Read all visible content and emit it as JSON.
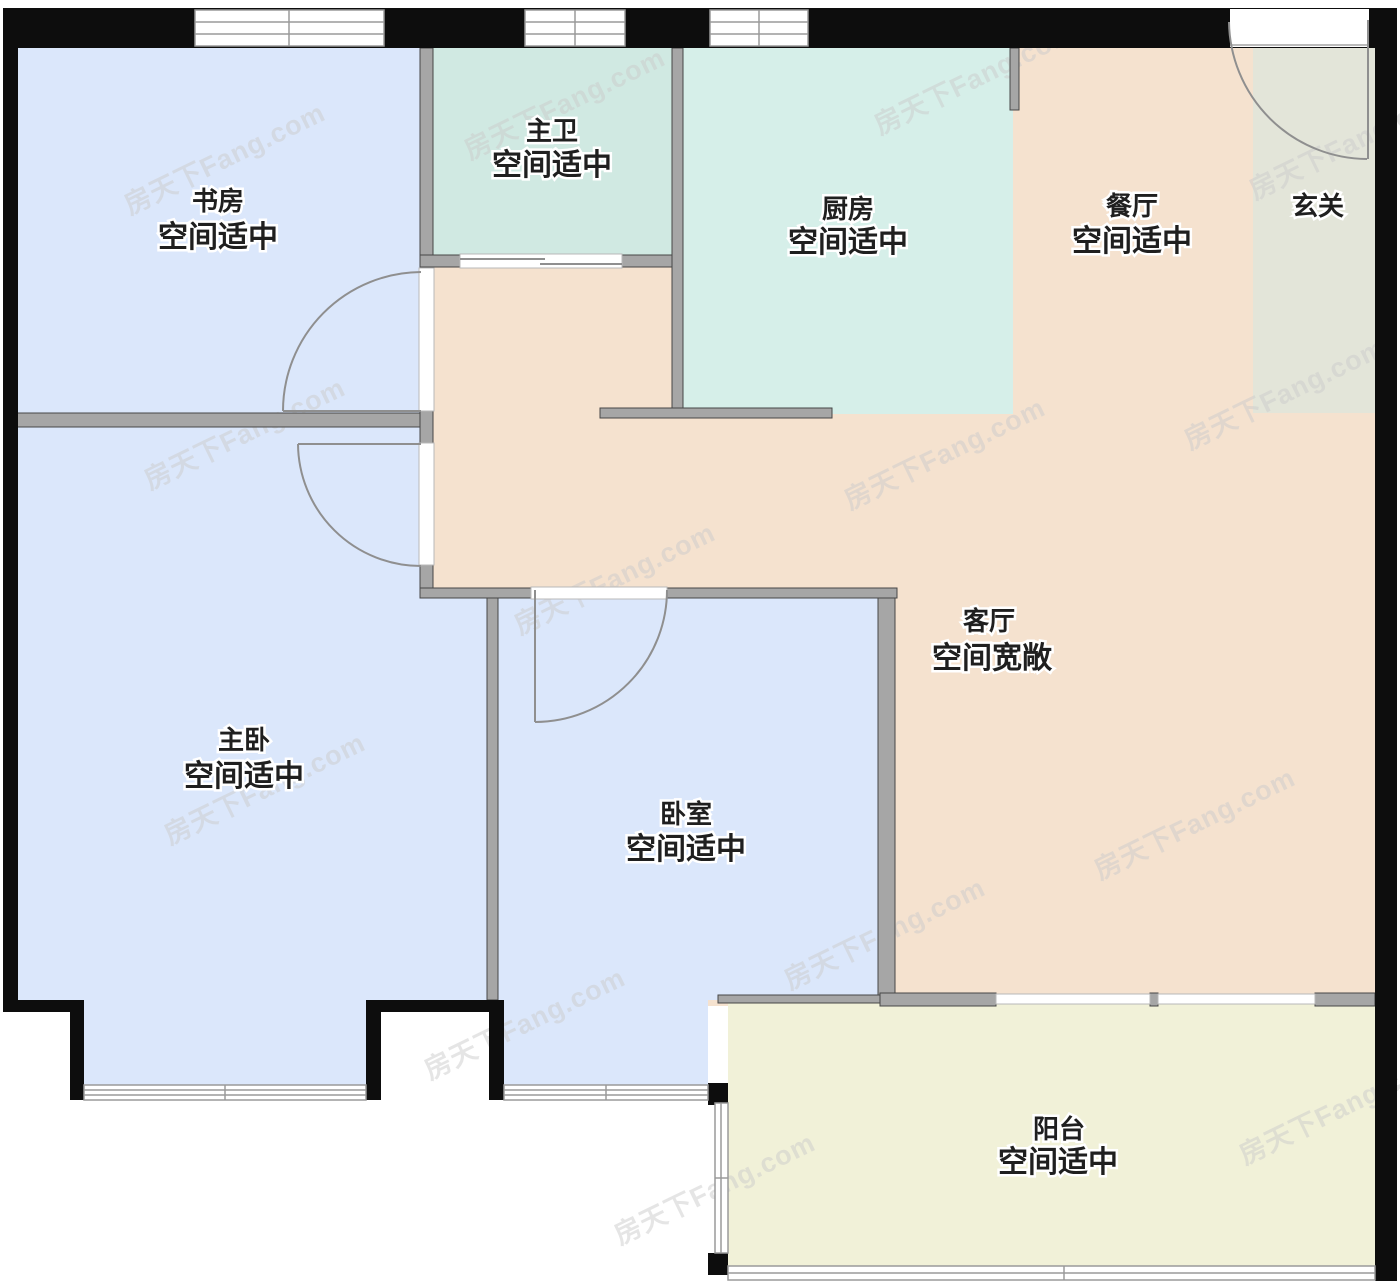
{
  "watermark": {
    "text": "房天下Fang.com"
  },
  "colors": {
    "exterior_wall": "#0d0d0d",
    "interior_wall": "#a6a6a6",
    "bedroom_fill": "#dbe7fb",
    "bath_fill": "#d0e9e2",
    "kitchen_fill": "#d6efe9",
    "living_fill": "#f5e2cf",
    "entry_fill": "#e3e5d9",
    "balcony_fill": "#f1f1d8"
  },
  "rooms": {
    "study": {
      "name": "书房",
      "status": "空间适中"
    },
    "master_bath": {
      "name": "主卫",
      "status": "空间适中"
    },
    "kitchen": {
      "name": "厨房",
      "status": "空间适中"
    },
    "dining": {
      "name": "餐厅",
      "status": "空间适中"
    },
    "entry": {
      "name": "玄关"
    },
    "living": {
      "name": "客厅",
      "status": "空间宽敞"
    },
    "master_bedroom": {
      "name": "主卧",
      "status": "空间适中"
    },
    "bedroom": {
      "name": "卧室",
      "status": "空间适中"
    },
    "balcony": {
      "name": "阳台",
      "status": "空间适中"
    }
  }
}
